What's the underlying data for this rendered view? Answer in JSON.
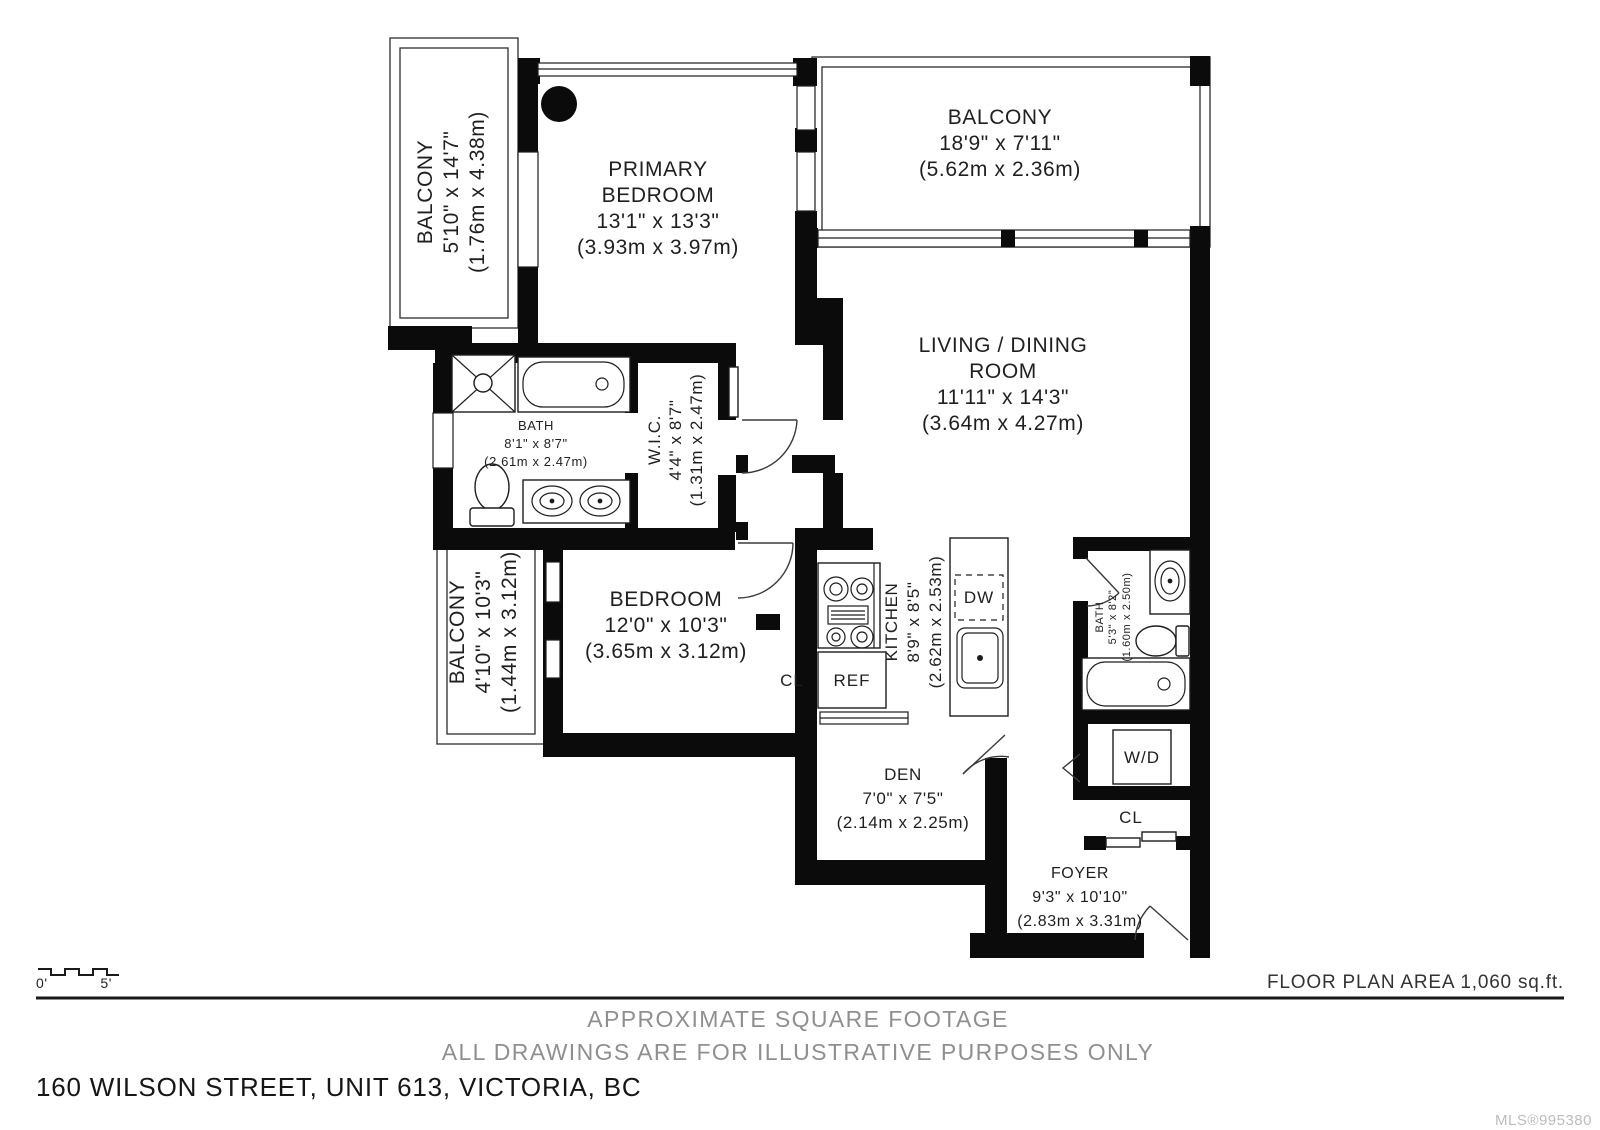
{
  "plan": {
    "rooms": {
      "balcony_top_left": {
        "name": "BALCONY",
        "dims_ft": "5'10\" x 14'7\"",
        "dims_m": "(1.76m x 4.38m)"
      },
      "primary_bedroom": {
        "name_line1": "PRIMARY",
        "name_line2": "BEDROOM",
        "dims_ft": "13'1\" x 13'3\"",
        "dims_m": "(3.93m x 3.97m)"
      },
      "balcony_top_right": {
        "name": "BALCONY",
        "dims_ft": "18'9\" x 7'11\"",
        "dims_m": "(5.62m x 2.36m)"
      },
      "living_dining": {
        "name_line1": "LIVING / DINING",
        "name_line2": "ROOM",
        "dims_ft": "11'11\" x 14'3\"",
        "dims_m": "(3.64m x 4.27m)"
      },
      "bath_main": {
        "name": "BATH",
        "dims_ft": "8'1\" x 8'7\"",
        "dims_m": "(2.61m x 2.47m)"
      },
      "wic": {
        "name": "W.I.C.",
        "dims_ft": "4'4\" x 8'7\"",
        "dims_m": "(1.31m x 2.47m)"
      },
      "balcony_left": {
        "name": "BALCONY",
        "dims_ft": "4'10\" x 10'3\"",
        "dims_m": "(1.44m x 3.12m)"
      },
      "bedroom": {
        "name": "BEDROOM",
        "dims_ft": "12'0\" x 10'3\"",
        "dims_m": "(3.65m x 3.12m)"
      },
      "kitchen": {
        "name": "KITCHEN",
        "dims_ft": "8'9\" x 8'5\"",
        "dims_m": "(2.62m x 2.53m)"
      },
      "den": {
        "name": "DEN",
        "dims_ft": "7'0\" x 7'5\"",
        "dims_m": "(2.14m x 2.25m)"
      },
      "bath_small": {
        "name": "BATH",
        "dims_ft": "5'3\" x 8'2\"",
        "dims_m": "(1.60m x 2.50m)"
      },
      "foyer": {
        "name": "FOYER",
        "dims_ft": "9'3\" x 10'10\"",
        "dims_m": "(2.83m x 3.31m)"
      }
    },
    "fixtures": {
      "fridge": "REF",
      "dishwasher": "DW",
      "washer_dryer": "W/D",
      "closet_bedroom": "CL",
      "closet_foyer": "CL"
    },
    "scale_bar": {
      "start": "0'",
      "end": "5'"
    }
  },
  "footer": {
    "area_label": "FLOOR PLAN AREA 1,060 sq.ft.",
    "disclaimer_line1": "APPROXIMATE SQUARE FOOTAGE",
    "disclaimer_line2": "ALL DRAWINGS ARE FOR ILLUSTRATIVE PURPOSES ONLY",
    "address": "160 WILSON STREET, UNIT 613, VICTORIA, BC",
    "mls": "MLS®995380"
  },
  "colors": {
    "wall": "#0b0b0b",
    "text_dark": "#1f1f1f",
    "text_gray": "#8f8f8f",
    "text_light": "#bcbcbc"
  }
}
